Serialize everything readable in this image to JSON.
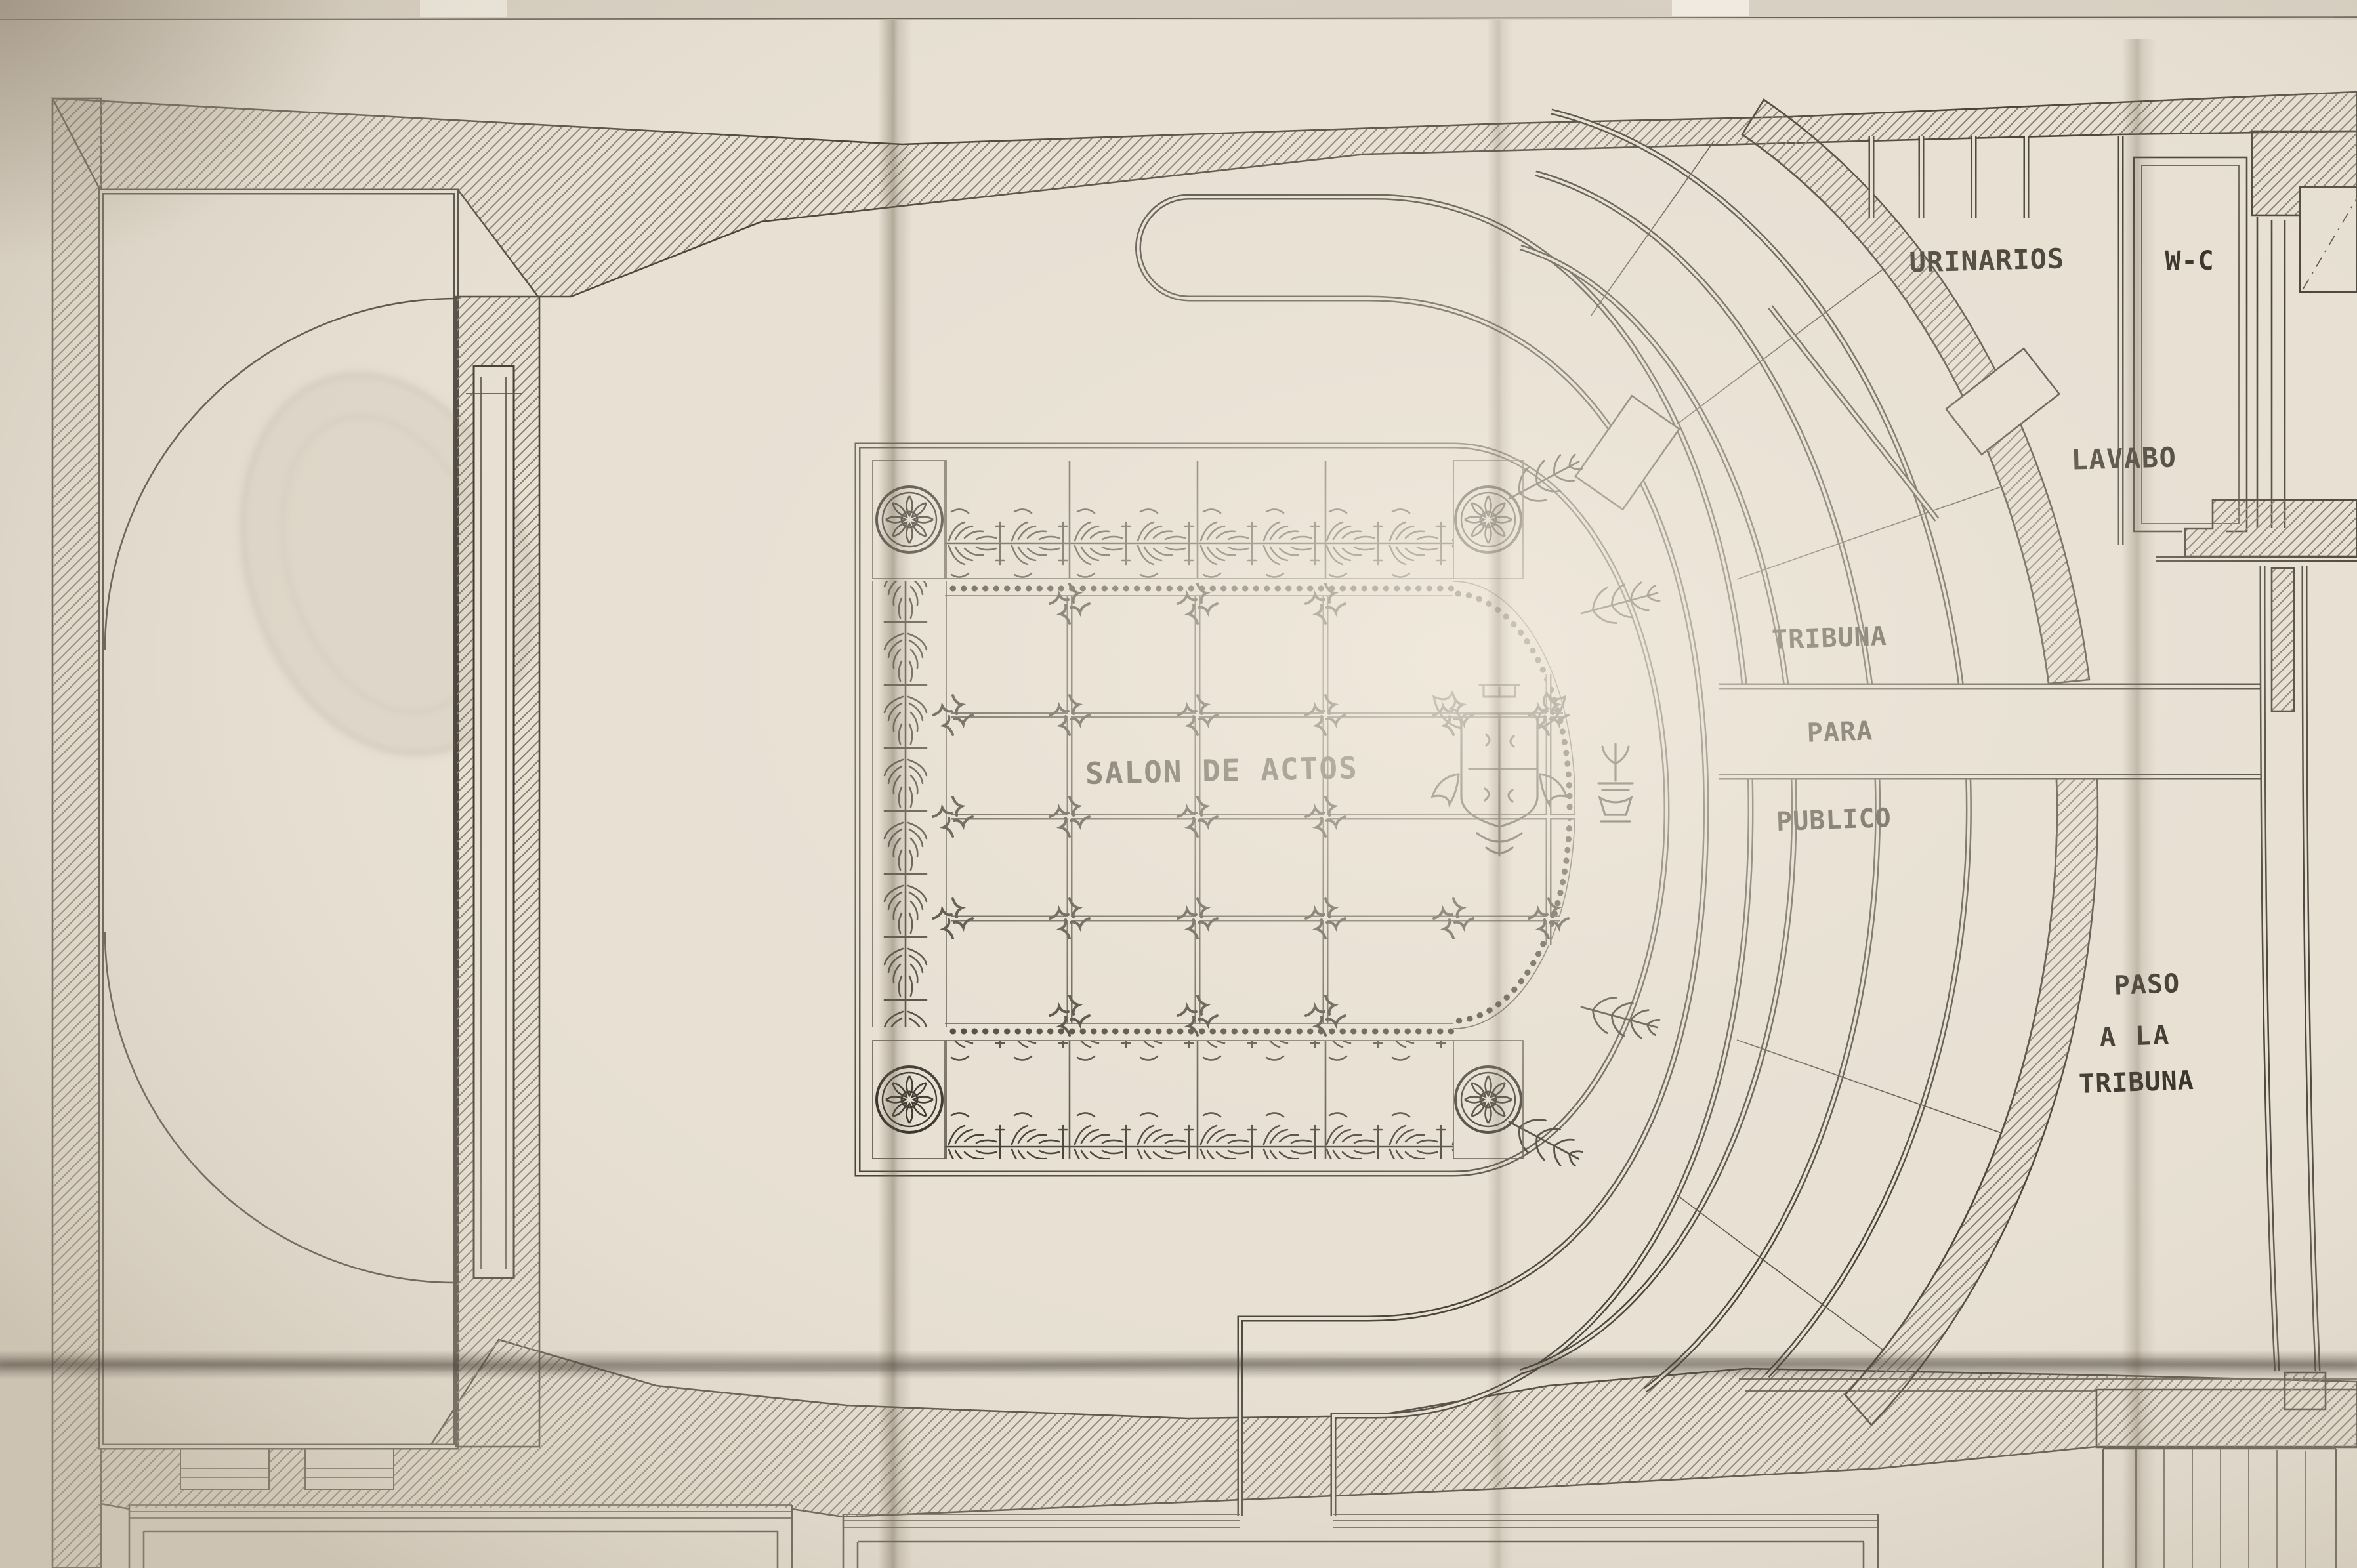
{
  "document": {
    "kind": "historic architectural floor plan (photographed ink drawing)",
    "language": "Spanish"
  },
  "labels": {
    "urinarios": "URINARIOS",
    "wc": "W-C",
    "lavabo": "LAVABO",
    "tribuna_l1": "TRIBUNA",
    "tribuna_l2": "PARA",
    "tribuna_l3": "PUBLICO",
    "salon": "SALON DE ACTOS",
    "paso_l1": "PASO",
    "paso_l2": "A LA",
    "paso_l3": "TRIBUNA"
  },
  "areas": [
    {
      "id": "salon-de-actos",
      "label": "SALON DE ACTOS",
      "description": "main assembly hall with coffered ornamental ceiling"
    },
    {
      "id": "tribuna-para-publico",
      "label": "TRIBUNA PARA PUBLICO",
      "description": "curved public gallery rows around hall apse"
    },
    {
      "id": "urinarios",
      "label": "URINARIOS",
      "description": "urinal room, top right"
    },
    {
      "id": "wc",
      "label": "W-C",
      "description": "toilet room, top right"
    },
    {
      "id": "lavabo",
      "label": "LAVABO",
      "description": "washroom area, right"
    },
    {
      "id": "paso-a-la-tribuna",
      "label": "PASO A LA TRIBUNA",
      "description": "passage to the gallery, right side"
    }
  ],
  "colors": {
    "paper": "#e7e0d3",
    "paper_bright": "#f0e9dc",
    "paper_shadow": "#c6bcad",
    "line": "#4a433a",
    "ink_dark": "#332d25",
    "hatch": "#847a6b",
    "crease": "#6b5d4c"
  }
}
